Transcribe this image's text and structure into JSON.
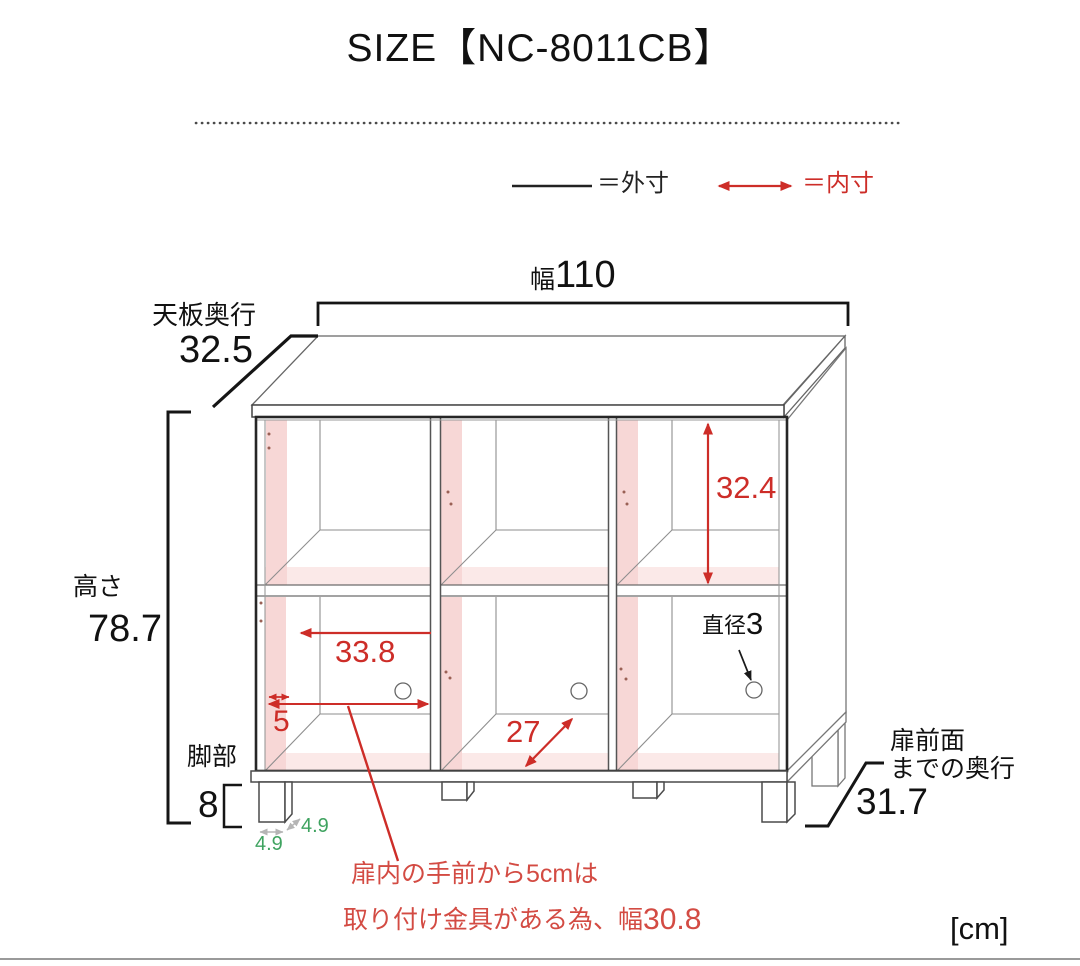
{
  "header": {
    "title": "SIZE【NC-8011CB】",
    "unit_label": "[cm]"
  },
  "legend": {
    "outer_label": "＝外寸",
    "inner_label": "＝内寸"
  },
  "colors": {
    "outer_dim_black": "#1a1a1a",
    "inner_dim_red": "#cd2d28",
    "note_red": "#d34b43",
    "leg_dim_green": "#3fa360",
    "interior_wall_pink": "#f7d7d6",
    "interior_floor_pink": "#fbe9e8"
  },
  "dims": {
    "width": {
      "label": "幅",
      "value": "110"
    },
    "top_depth": {
      "label": "天板奥行",
      "value": "32.5"
    },
    "height": {
      "label": "高さ",
      "value": "78.7"
    },
    "legs": {
      "label": "脚部",
      "value": "8"
    },
    "inner_height": {
      "value": "32.4"
    },
    "inner_width": {
      "value": "33.8"
    },
    "front_margin": {
      "value": "5"
    },
    "inner_depth": {
      "value": "27"
    },
    "hole_diameter": {
      "label": "直径",
      "value": "3"
    },
    "front_depth": {
      "label_line1": "扉前面",
      "label_line2": "までの奥行",
      "value": "31.7"
    },
    "leg_depth": {
      "value": "4.9"
    },
    "leg_width": {
      "value": "4.9"
    }
  },
  "note": {
    "line1": "扉内の手前から5cmは",
    "line2_prefix": "取り付け金具がある為、幅",
    "line2_value": "30.8"
  }
}
